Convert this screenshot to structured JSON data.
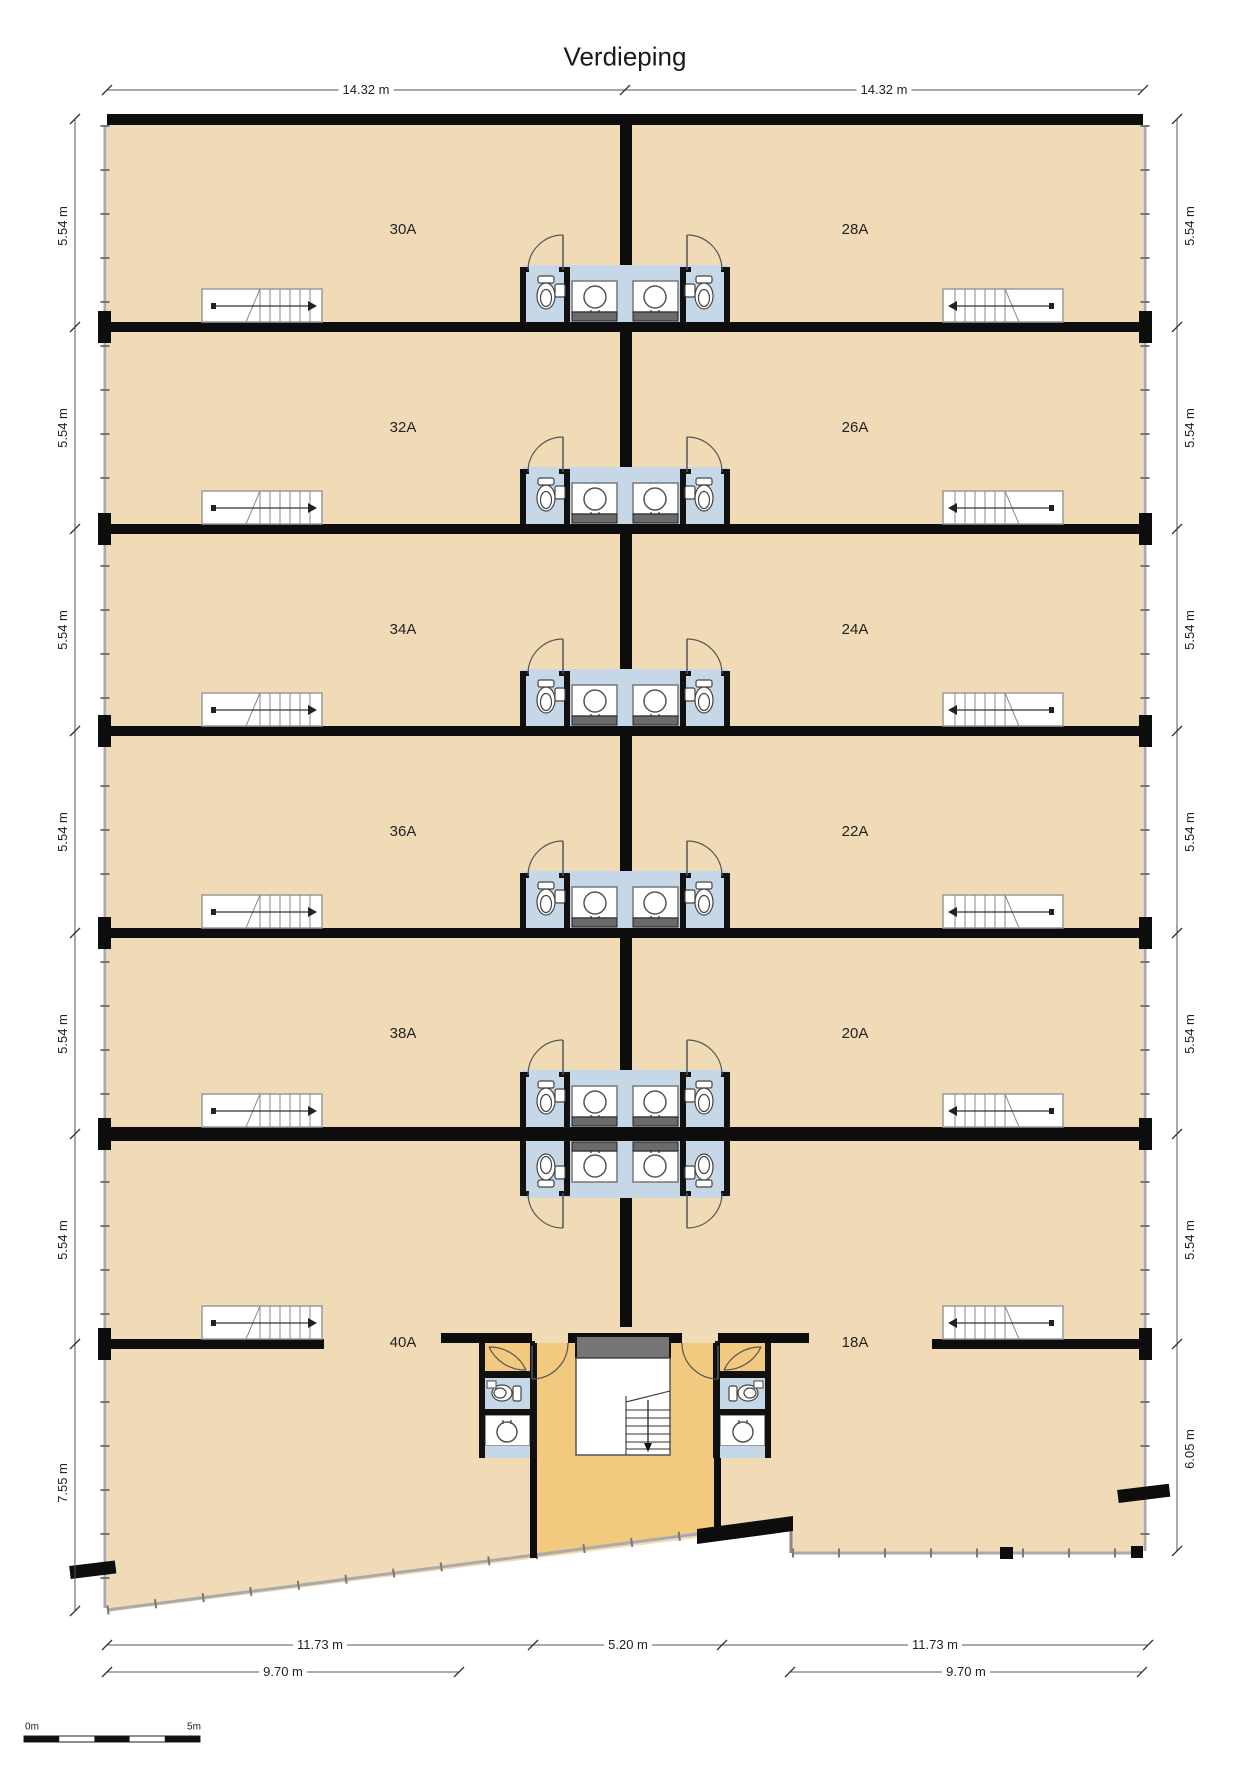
{
  "title": "Verdieping",
  "dimensions": {
    "top": [
      "14.32 m",
      "14.32 m"
    ],
    "left": [
      "5.54 m",
      "5.54 m",
      "5.54 m",
      "5.54 m",
      "5.54 m",
      "5.54 m",
      "7.55 m"
    ],
    "right": [
      "5.54 m",
      "5.54 m",
      "5.54 m",
      "5.54 m",
      "5.54 m",
      "5.54 m",
      "6.05 m"
    ],
    "bottom_inner": [
      "11.73 m",
      "5.20 m",
      "11.73 m"
    ],
    "bottom_outer": [
      "9.70 m",
      "9.70 m"
    ]
  },
  "rooms": [
    {
      "label": "30A"
    },
    {
      "label": "28A"
    },
    {
      "label": "32A"
    },
    {
      "label": "26A"
    },
    {
      "label": "34A"
    },
    {
      "label": "24A"
    },
    {
      "label": "36A"
    },
    {
      "label": "22A"
    },
    {
      "label": "38A"
    },
    {
      "label": "20A"
    },
    {
      "label": "40A"
    },
    {
      "label": "18A"
    }
  ],
  "scale_bar": {
    "start_label": "0m",
    "end_label": "5m"
  },
  "colors": {
    "room_fill": "#f1dbb6",
    "hall_fill": "#f2c97e",
    "bathroom_fill": "#c6d8e7",
    "counter_gray": "#6b6b6b",
    "wall": "#0d0d0d"
  }
}
